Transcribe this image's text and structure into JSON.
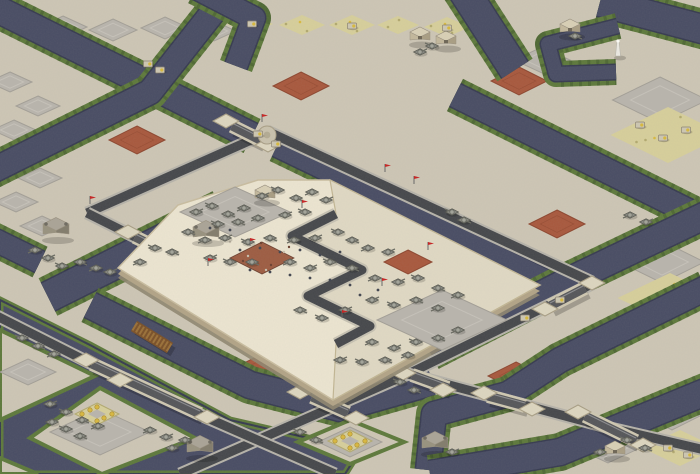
{
  "scene": {
    "kind": "isometric-rts-desert-map",
    "width": 700,
    "height": 474
  },
  "palette": {
    "sand": "#cdc6b5",
    "sand_light": "#d9d3c3",
    "cobble": "#b9b5ad",
    "cobble_edge": "#a39f97",
    "cobble_inner": "#c6c2ba",
    "ore": "#d7cf9b",
    "ore_speck": "#b2a96f",
    "ore_gold": "#d9b93f",
    "ore_gold_edge": "#a8862e",
    "red_patch": "#a8583d",
    "red_patch_edge": "#8d462f",
    "water": "#484c64",
    "water_edge": "#363a50",
    "grass": "#5d793b",
    "grass_dark": "#466030",
    "road_shoulder": "#b6b3aa",
    "road_asphalt": "#45474b",
    "bridge_rail": "#cfc8b2",
    "bridge_deck": "#55565a",
    "wood_bridge": "#7a5028",
    "wood_slat": "#9a7038",
    "pad": "#ddd6c0",
    "pad_edge": "#a89e85",
    "platform_wall": "#b2a487",
    "platform_wall_dark": "#8f8670",
    "platform_top": "#ece5d1",
    "platform_lower": "#e0d9c4",
    "platform_rim": "#c9bda0",
    "dirt": "#9d5c42",
    "dirt_debris": "#6b4030",
    "tank_hull": "#868780",
    "tank_dark": "#575850",
    "tank_turret": "#a3a49a",
    "tank_barrel": "#6a6b62",
    "truck": "#cdc7b2",
    "truck_edge": "#8a8272",
    "truck_cab": "#d8b93c",
    "infantry": "#40444f",
    "flag_red": "#c62222",
    "flag_pole": "#666666",
    "bld_top": "#d9d0b6",
    "bld_left": "#c3b89c",
    "bld_right": "#a99e83",
    "bld_edge": "#9a9180",
    "fort_top": "#aaa497",
    "fort_left": "#98927f",
    "fort_right": "#827c6c",
    "tower_white": "#eceae3",
    "shadow": "#000000"
  },
  "terrain": {
    "cobble_patches": [
      [
        63,
        27,
        48,
        22
      ],
      [
        113,
        30,
        48,
        22
      ],
      [
        165,
        28,
        48,
        22
      ],
      [
        214,
        31,
        44,
        20
      ],
      [
        248,
        20,
        40,
        18
      ],
      [
        10,
        82,
        44,
        20
      ],
      [
        38,
        106,
        44,
        20
      ],
      [
        14,
        130,
        44,
        20
      ],
      [
        40,
        178,
        44,
        20
      ],
      [
        16,
        202,
        44,
        20
      ],
      [
        42,
        226,
        44,
        20
      ],
      [
        16,
        250,
        44,
        20
      ],
      [
        660,
        100,
        95,
        46
      ],
      [
        662,
        262,
        85,
        42
      ],
      [
        672,
        415,
        60,
        30
      ],
      [
        608,
        448,
        64,
        30
      ],
      [
        28,
        372,
        56,
        26
      ],
      [
        542,
        60,
        56,
        26
      ]
    ],
    "ore_patches": [
      [
        250,
        24,
        46,
        20
      ],
      [
        302,
        25,
        46,
        20
      ],
      [
        352,
        25,
        46,
        20
      ],
      [
        398,
        25,
        42,
        18
      ],
      [
        447,
        27,
        46,
        20
      ],
      [
        248,
        20,
        30,
        13
      ],
      [
        668,
        135,
        115,
        56
      ],
      [
        670,
        298,
        105,
        50
      ],
      [
        680,
        448,
        75,
        36
      ]
    ],
    "ore_rings": [
      [
        97,
        414
      ],
      [
        350,
        441
      ]
    ],
    "red_patches": [
      [
        137,
        140,
        56,
        28
      ],
      [
        301,
        86,
        56,
        28
      ],
      [
        519,
        81,
        56,
        28
      ],
      [
        557,
        224,
        56,
        28
      ],
      [
        258,
        370,
        56,
        28
      ],
      [
        516,
        376,
        56,
        28
      ]
    ]
  },
  "water": {
    "channels": [
      {
        "p": [
          [
            -15,
            3
          ],
          [
            150,
            85
          ],
          [
            252,
            136
          ]
        ],
        "w": 26
      },
      {
        "p": [
          [
            232,
            -12
          ],
          [
            150,
            92
          ],
          [
            58,
            138
          ],
          [
            -10,
            172
          ]
        ],
        "w": 24
      },
      {
        "p": [
          [
            40,
            262
          ],
          [
            -15,
            235
          ]
        ],
        "w": 22
      },
      {
        "p": [
          [
            196,
            -12
          ],
          [
            254,
            18
          ],
          [
            236,
            66
          ]
        ],
        "w": 22
      },
      {
        "p": [
          [
            276,
            148
          ],
          [
            558,
            284
          ]
        ],
        "w": 17
      },
      {
        "p": [
          [
            600,
            2
          ],
          [
            706,
            30
          ]
        ],
        "w": 28
      },
      {
        "p": [
          [
            462,
            -12
          ],
          [
            515,
            70
          ]
        ],
        "w": 30
      },
      {
        "p": [
          [
            618,
            26
          ],
          [
            548,
            44
          ],
          [
            556,
            74
          ],
          [
            616,
            72
          ]
        ],
        "w": 14
      },
      {
        "p": [
          [
            455,
            95
          ],
          [
            706,
            220
          ]
        ],
        "w": 24
      },
      {
        "p": [
          [
            706,
            215
          ],
          [
            566,
            282
          ],
          [
            430,
            352
          ]
        ],
        "w": 26
      },
      {
        "p": [
          [
            222,
            210
          ],
          [
            48,
            297
          ]
        ],
        "w": 30
      },
      {
        "p": [
          [
            90,
            305
          ],
          [
            250,
            385
          ],
          [
            340,
            408
          ],
          [
            432,
            382
          ]
        ],
        "w": 26
      },
      {
        "p": [
          [
            706,
            288
          ],
          [
            560,
            360
          ],
          [
            508,
            394
          ],
          [
            434,
            414
          ],
          [
            428,
            470
          ]
        ],
        "w": 24
      },
      {
        "p": [
          [
            710,
            390
          ],
          [
            560,
            452
          ],
          [
            430,
            474
          ]
        ],
        "w": 26
      },
      {
        "p": [
          [
            -15,
            318
          ],
          [
            80,
            362
          ]
        ],
        "w": 22
      }
    ],
    "ponds": [
      {
        "p": [
          [
            0,
            300
          ],
          [
            90,
            345
          ],
          [
            230,
            420
          ],
          [
            360,
            450
          ],
          [
            345,
            474
          ],
          [
            0,
            474
          ]
        ]
      }
    ]
  },
  "land": {
    "strips": [
      {
        "p": [
          [
            0,
            330
          ],
          [
            95,
            376
          ],
          [
            0,
            420
          ]
        ],
        "cobble": [
          28,
          372,
          56,
          26
        ]
      },
      {
        "p": [
          [
            0,
            458
          ],
          [
            38,
            474
          ],
          [
            0,
            474
          ]
        ],
        "cobble": null
      }
    ],
    "islands": [
      {
        "p": [
          [
            30,
            438
          ],
          [
            100,
            388
          ],
          [
            195,
            438
          ],
          [
            102,
            474
          ]
        ],
        "cobble": [
          100,
          432,
          100,
          46
        ],
        "ring": [
          97,
          414
        ]
      },
      {
        "p": [
          [
            298,
            442
          ],
          [
            350,
            420
          ],
          [
            404,
            442
          ],
          [
            350,
            464
          ]
        ],
        "cobble": [
          350,
          442,
          64,
          30
        ],
        "ring": [
          350,
          441
        ]
      }
    ]
  },
  "roads": [
    {
      "p": [
        [
          87,
          213
        ],
        [
          267,
          133
        ]
      ]
    },
    {
      "p": [
        [
          267,
          131
        ],
        [
          592,
          282
        ]
      ]
    },
    {
      "p": [
        [
          592,
          284
        ],
        [
          408,
          374
        ],
        [
          180,
          474
        ]
      ]
    },
    {
      "p": [
        [
          87,
          213
        ],
        [
          205,
          272
        ]
      ]
    },
    {
      "p": [
        [
          336,
          214
        ],
        [
          292,
          236
        ],
        [
          362,
          270
        ],
        [
          308,
          296
        ],
        [
          370,
          326
        ],
        [
          336,
          344
        ]
      ],
      "light": true
    },
    {
      "p": [
        [
          336,
          344
        ],
        [
          408,
          374
        ],
        [
          610,
          428
        ],
        [
          705,
          450
        ]
      ]
    },
    {
      "p": [
        [
          -15,
          310
        ],
        [
          88,
          362
        ],
        [
          205,
          417
        ],
        [
          335,
          474
        ]
      ]
    }
  ],
  "bridges": [
    {
      "p": [
        [
          232,
          126
        ],
        [
          262,
          141
        ]
      ]
    },
    {
      "p": [
        [
          135,
          237
        ],
        [
          180,
          259
        ]
      ]
    },
    {
      "p": [
        [
          412,
          375
        ],
        [
          448,
          388
        ]
      ]
    },
    {
      "p": [
        [
          585,
          288
        ],
        [
          550,
          306
        ]
      ]
    },
    {
      "p": [
        [
          585,
          416
        ],
        [
          636,
          441
        ]
      ]
    },
    {
      "p": [
        [
          312,
          397
        ],
        [
          348,
          413
        ]
      ]
    },
    {
      "p": [
        [
          92,
          364
        ],
        [
          200,
          414
        ]
      ]
    },
    {
      "p": [
        [
          488,
          396
        ],
        [
          525,
          406
        ]
      ]
    }
  ],
  "wooden_bridge": {
    "p": [
      [
        134,
        326
      ],
      [
        170,
        348
      ]
    ]
  },
  "pads": [
    [
      226,
      121
    ],
    [
      268,
      145
    ],
    [
      128,
      232
    ],
    [
      187,
      263
    ],
    [
      403,
      373
    ],
    [
      443,
      390
    ],
    [
      592,
      283
    ],
    [
      545,
      309
    ],
    [
      578,
      412
    ],
    [
      643,
      445
    ],
    [
      300,
      392
    ],
    [
      356,
      418
    ],
    [
      86,
      360
    ],
    [
      207,
      417
    ],
    [
      484,
      393
    ],
    [
      532,
      409
    ],
    [
      336,
      212
    ],
    [
      336,
      342
    ],
    [
      205,
      272
    ],
    [
      120,
      380
    ]
  ],
  "roundabout": [
    267,
    135
  ],
  "platform": {
    "outline": [
      [
        330,
        180
      ],
      [
        540,
        285
      ],
      [
        333,
        400
      ],
      [
        118,
        268
      ],
      [
        178,
        205
      ],
      [
        258,
        180
      ]
    ],
    "lower_terrace": [
      [
        336,
        214
      ],
      [
        292,
        236
      ],
      [
        362,
        270
      ],
      [
        308,
        296
      ],
      [
        370,
        326
      ],
      [
        336,
        344
      ],
      [
        333,
        400
      ],
      [
        540,
        285
      ],
      [
        330,
        180
      ]
    ],
    "cobble_areas": [
      [
        235,
        212,
        110,
        50
      ],
      [
        442,
        320,
        130,
        60
      ]
    ],
    "dirt_patch": [
      262,
      258,
      64,
      32
    ],
    "red_pad": [
      408,
      262,
      48,
      24
    ]
  },
  "structures": [
    {
      "x": 420,
      "y": 38,
      "kind": "b"
    },
    {
      "x": 446,
      "y": 42,
      "kind": "b"
    },
    {
      "x": 570,
      "y": 30,
      "kind": "b"
    },
    {
      "x": 56,
      "y": 232,
      "kind": "f"
    },
    {
      "x": 200,
      "y": 450,
      "kind": "f"
    },
    {
      "x": 435,
      "y": 446,
      "kind": "f"
    },
    {
      "x": 615,
      "y": 452,
      "kind": "b"
    },
    {
      "x": 206,
      "y": 235,
      "kind": "f"
    },
    {
      "x": 265,
      "y": 196,
      "kind": "b"
    },
    {
      "x": 618,
      "y": 56,
      "kind": "t"
    }
  ],
  "units": {
    "tanks": [
      [
        196,
        212
      ],
      [
        212,
        206
      ],
      [
        228,
        214
      ],
      [
        244,
        208
      ],
      [
        262,
        196
      ],
      [
        278,
        190
      ],
      [
        296,
        198
      ],
      [
        312,
        192
      ],
      [
        326,
        200
      ],
      [
        218,
        224
      ],
      [
        238,
        222
      ],
      [
        258,
        218
      ],
      [
        285,
        215
      ],
      [
        305,
        212
      ],
      [
        188,
        232
      ],
      [
        205,
        240
      ],
      [
        225,
        238
      ],
      [
        248,
        242
      ],
      [
        270,
        238
      ],
      [
        294,
        240
      ],
      [
        315,
        238
      ],
      [
        338,
        232
      ],
      [
        352,
        240
      ],
      [
        368,
        248
      ],
      [
        388,
        252
      ],
      [
        155,
        248
      ],
      [
        172,
        252
      ],
      [
        140,
        262
      ],
      [
        210,
        258
      ],
      [
        230,
        262
      ],
      [
        252,
        262
      ],
      [
        290,
        262
      ],
      [
        310,
        268
      ],
      [
        330,
        262
      ],
      [
        352,
        268
      ],
      [
        375,
        278
      ],
      [
        398,
        282
      ],
      [
        418,
        278
      ],
      [
        438,
        288
      ],
      [
        458,
        295
      ],
      [
        372,
        300
      ],
      [
        394,
        305
      ],
      [
        416,
        300
      ],
      [
        438,
        308
      ],
      [
        345,
        310
      ],
      [
        322,
        318
      ],
      [
        300,
        310
      ],
      [
        372,
        342
      ],
      [
        394,
        348
      ],
      [
        416,
        342
      ],
      [
        438,
        338
      ],
      [
        458,
        330
      ],
      [
        340,
        360
      ],
      [
        362,
        362
      ],
      [
        385,
        360
      ],
      [
        408,
        355
      ],
      [
        420,
        52
      ],
      [
        432,
        46
      ],
      [
        575,
        36
      ],
      [
        630,
        215
      ],
      [
        646,
        222
      ],
      [
        452,
        212
      ],
      [
        464,
        220
      ],
      [
        35,
        250
      ],
      [
        48,
        258
      ],
      [
        62,
        266
      ],
      [
        80,
        262
      ],
      [
        96,
        268
      ],
      [
        110,
        272
      ],
      [
        22,
        338
      ],
      [
        38,
        346
      ],
      [
        54,
        354
      ],
      [
        50,
        404
      ],
      [
        66,
        412
      ],
      [
        82,
        420
      ],
      [
        98,
        426
      ],
      [
        52,
        422
      ],
      [
        66,
        429
      ],
      [
        80,
        436
      ],
      [
        150,
        430
      ],
      [
        166,
        437
      ],
      [
        300,
        432
      ],
      [
        316,
        440
      ],
      [
        185,
        440
      ],
      [
        172,
        448
      ],
      [
        627,
        440
      ],
      [
        645,
        448
      ],
      [
        600,
        452
      ],
      [
        452,
        452
      ],
      [
        400,
        382
      ],
      [
        414,
        390
      ]
    ],
    "trucks": [
      [
        258,
        134
      ],
      [
        276,
        144
      ],
      [
        560,
        300
      ],
      [
        525,
        318
      ],
      [
        640,
        125
      ],
      [
        663,
        138
      ],
      [
        686,
        130
      ],
      [
        252,
        24
      ],
      [
        352,
        26
      ],
      [
        447,
        28
      ],
      [
        688,
        455
      ],
      [
        668,
        448
      ],
      [
        148,
        64
      ],
      [
        160,
        70
      ]
    ],
    "infantry": [
      [
        240,
        250
      ],
      [
        260,
        248
      ],
      [
        280,
        252
      ],
      [
        300,
        250
      ],
      [
        320,
        255
      ],
      [
        340,
        252
      ],
      [
        250,
        270
      ],
      [
        270,
        272
      ],
      [
        290,
        275
      ],
      [
        310,
        278
      ],
      [
        330,
        280
      ],
      [
        350,
        285
      ],
      [
        230,
        230
      ],
      [
        210,
        228
      ],
      [
        360,
        295
      ],
      [
        378,
        290
      ]
    ],
    "flags": [
      [
        302,
        208
      ],
      [
        250,
        246
      ],
      [
        382,
        286
      ],
      [
        342,
        318
      ],
      [
        428,
        250
      ],
      [
        208,
        266
      ],
      [
        90,
        204
      ],
      [
        262,
        122
      ],
      [
        385,
        172
      ],
      [
        414,
        184
      ]
    ]
  }
}
